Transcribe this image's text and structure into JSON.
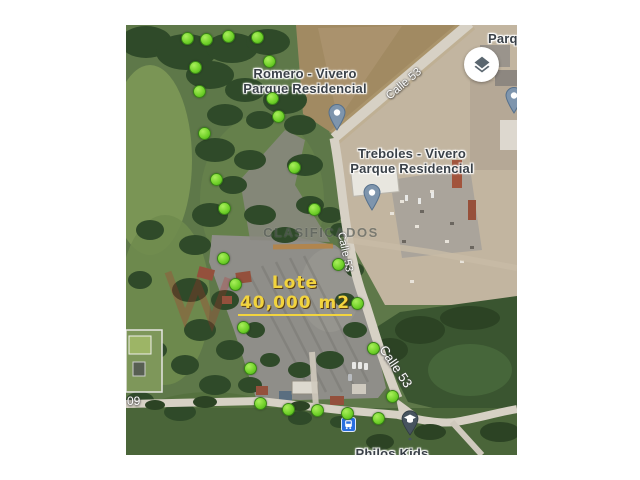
{
  "map": {
    "place_labels": {
      "romero_line1": "Romero - Vivero",
      "romero_line2": "Parque Residencial",
      "treboles_line1": "Treboles - Vivero",
      "treboles_line2": "Parque Residencial",
      "parque_partial": "Parque",
      "philos_kids": "Philos Kids"
    },
    "road_labels": {
      "calle53": "Calle 53",
      "street_partial": "09"
    },
    "lot_overlay": {
      "title": "Lote",
      "area": "40,000 m2",
      "text_color": "#f2d43e"
    },
    "watermark": {
      "text": "CLASIFICADOS"
    },
    "markers": {
      "dot_color": "#6fd028",
      "boundary_dots": [
        [
          186,
          37
        ],
        [
          205,
          38
        ],
        [
          227,
          35
        ],
        [
          256,
          36
        ],
        [
          194,
          66
        ],
        [
          268,
          60
        ],
        [
          198,
          90
        ],
        [
          271,
          97
        ],
        [
          277,
          115
        ],
        [
          203,
          132
        ],
        [
          215,
          178
        ],
        [
          293,
          166
        ],
        [
          223,
          207
        ],
        [
          313,
          208
        ],
        [
          222,
          257
        ],
        [
          337,
          263
        ],
        [
          234,
          283
        ],
        [
          356,
          302
        ],
        [
          242,
          326
        ],
        [
          372,
          347
        ],
        [
          249,
          367
        ],
        [
          391,
          395
        ],
        [
          259,
          402
        ],
        [
          287,
          408
        ],
        [
          316,
          409
        ],
        [
          346,
          412
        ],
        [
          377,
          417
        ]
      ]
    }
  }
}
